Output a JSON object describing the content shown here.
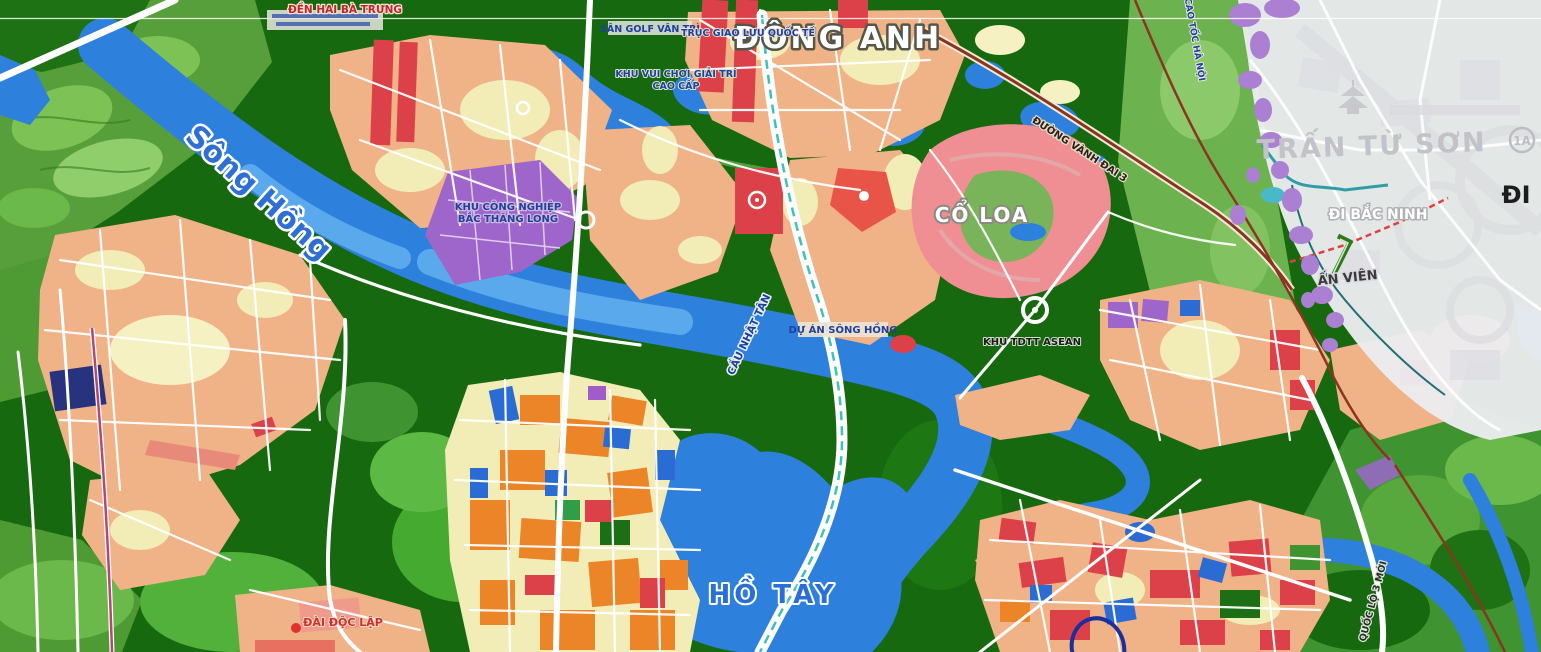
{
  "map": {
    "labels": {
      "dong_anh": "ĐÔNG ANH",
      "song_hong": "Sông Hồng",
      "ho_tay": "HỒ TÂY",
      "co_loa": "CỔ LOA",
      "tran_tu_son": "TRẤN TỪ SƠN",
      "di_bac_ninh": "ĐI BẮC NINH",
      "di": "ĐI",
      "an_vien": "ẤN VIÊN",
      "den_hai_ba_trung": "ĐỀN HAI BÀ TRƯNG",
      "san_golf_van_tri": "SÂN GOLF VÂN TRÌ",
      "truc_giao_luu_quoc_te": "TRỤC GIAO LƯU QUỐC TẾ",
      "khu_vui_choi_line1": "KHU VUI CHƠI GIẢI TRÍ",
      "khu_vui_choi_line2": "CAO CẤP",
      "khu_cong_nghiep_line1": "KHU CÔNG NGHIỆP",
      "khu_cong_nghiep_line2": "BẮC THĂNG LONG",
      "du_an_song_hong": "DỰ ÁN SÔNG HỒNG",
      "khu_tdtt_asean": "KHU TDTT ASEAN",
      "cau_nhat_tan": "CẦU NHẬT TÂN",
      "duong_vanh_dai_3": "ĐƯỜNG VÀNH ĐAI 3",
      "cao_toc_ha_noi": "CAO TỐC HÀ NỘI",
      "dai_doc_lap": "ĐÀI ĐỘC LẬP",
      "quoc_lo_3_moi": "QUỐC LỘ 3 MỚI",
      "route_badge_1a": "1A"
    },
    "colors": {
      "water": "#2e80dd",
      "water_light": "#5aa9ec",
      "green_dark": "#17690f",
      "green_mid": "#3f9330",
      "green_light": "#5fa83f",
      "urban_salmon": "#f0b287",
      "urban_cream": "#f2ecb6",
      "red_block": "#dc4048",
      "orange_block": "#ec8428",
      "purple_zone": "#9e66cb",
      "purple_blob": "#ab7fd2",
      "grey_zone": "#ececef",
      "road_white": "#ffffff",
      "railway": "#8a3520",
      "label_blue": "#1f3f9e",
      "co_loa_pink": "#ef8f93"
    }
  }
}
